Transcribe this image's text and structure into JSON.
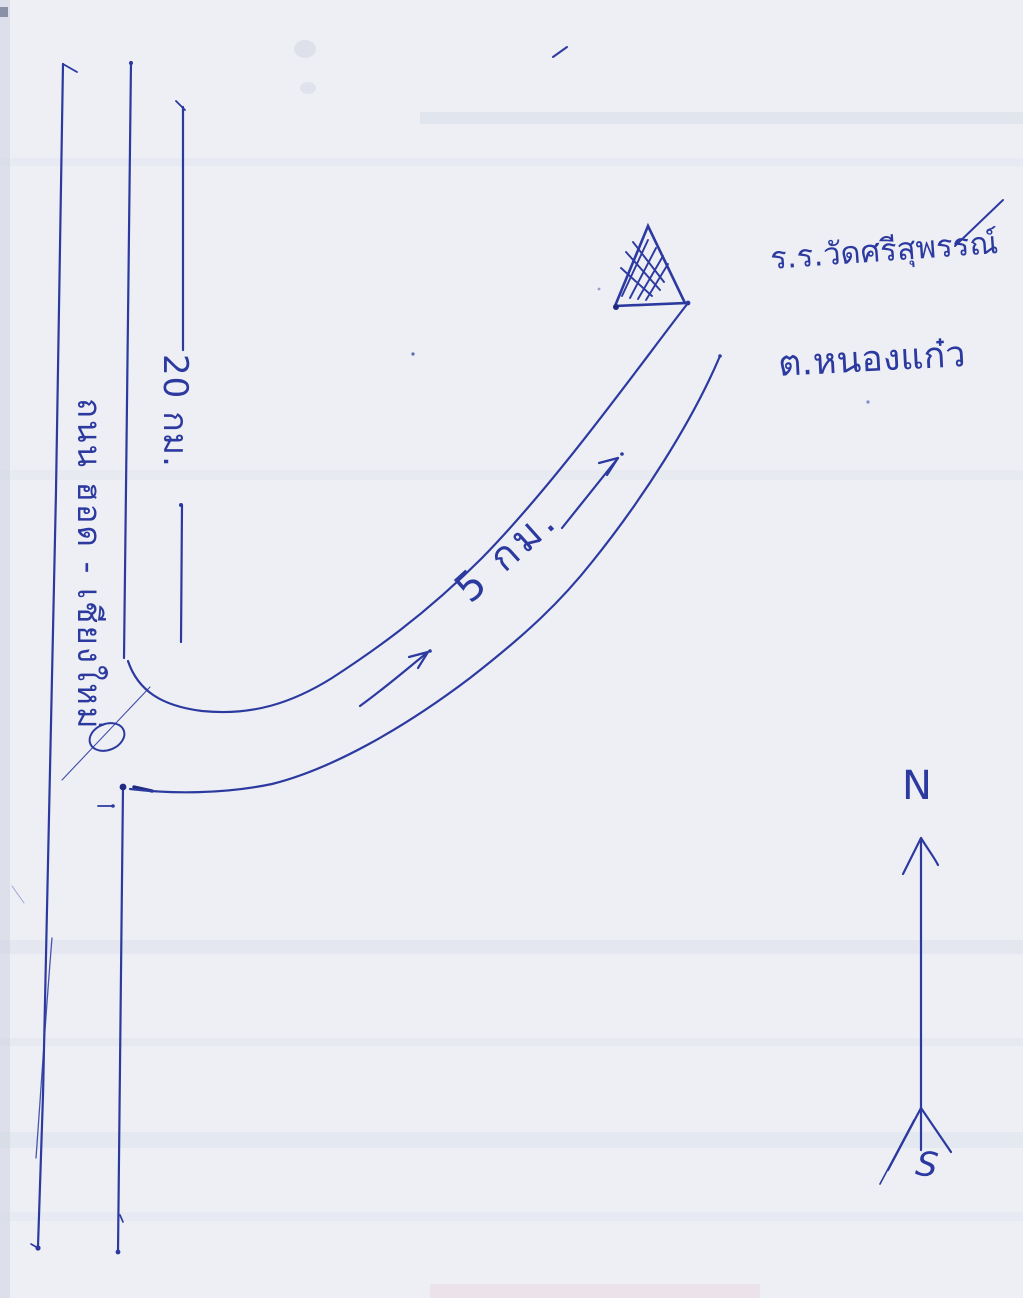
{
  "page": {
    "paper_color": "#edeff5",
    "ink_color": "#2c3aa0",
    "description_labels": {
      "road_symbol": "hand-drawn two-lane road",
      "landmark_symbol": "hatched triangle"
    }
  },
  "map": {
    "main_road": {
      "name": "ถนน ฮอด - เชียงใหม่",
      "distance": "20 กม."
    },
    "branch_road": {
      "distance": "5 กม."
    },
    "destination": {
      "school": "ร.ร.วัดศรีสุพรรณ์",
      "subdistrict": "ต.หนองแก๋ว"
    },
    "compass": {
      "north": "N",
      "south": "S"
    }
  }
}
